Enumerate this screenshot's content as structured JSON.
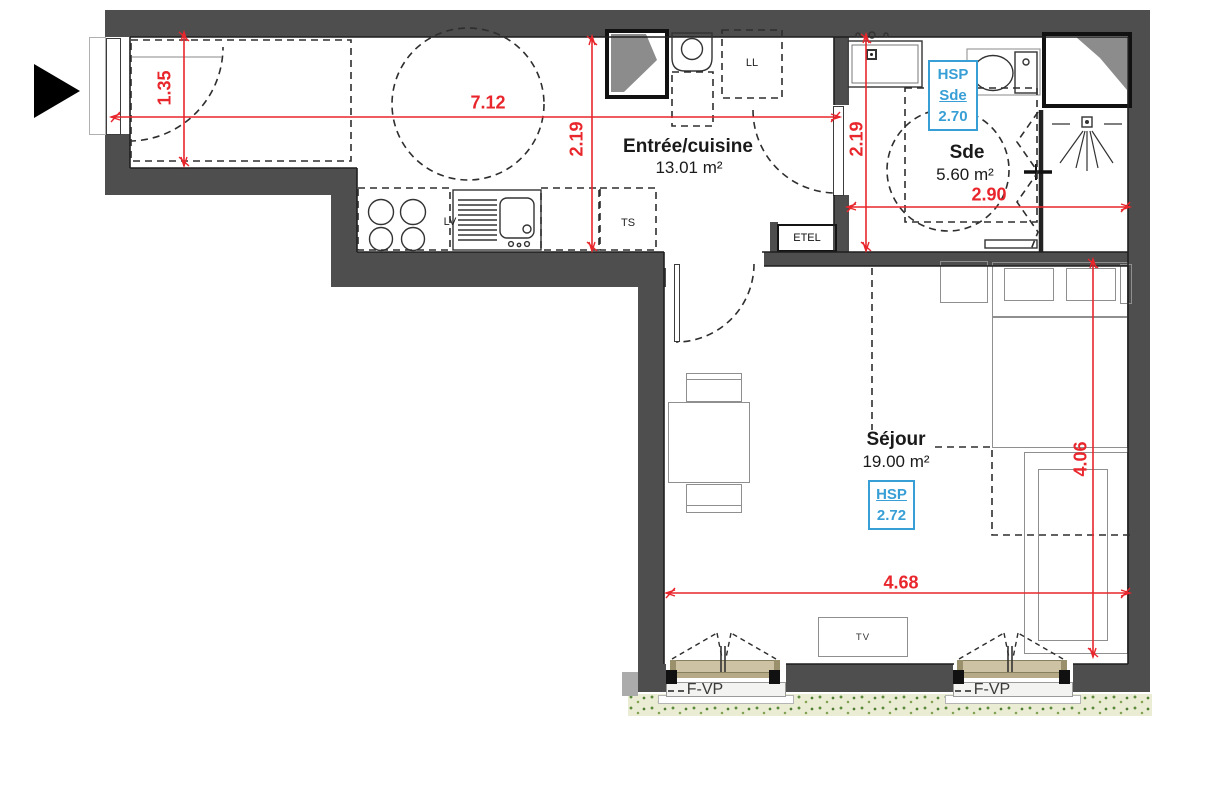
{
  "rooms": {
    "entree": {
      "name": "Entrée/cuisine",
      "area": "13.01 m²"
    },
    "sde": {
      "name": "Sde",
      "area": "5.60 m²"
    },
    "sejour": {
      "name": "Séjour",
      "area": "19.00 m²"
    }
  },
  "dimensions": {
    "closet_height": "1.35",
    "entree_width": "7.12",
    "entree_depth": "2.19",
    "sde_depth": "2.19",
    "sde_width": "2.90",
    "sejour_depth": "4.06",
    "sejour_width": "4.68"
  },
  "ceiling_heights": {
    "sde": {
      "label": "HSP",
      "room": "Sde",
      "value": "2.70"
    },
    "sejour": {
      "label": "HSP",
      "value": "2.72"
    }
  },
  "equipment": {
    "washing_machine": "LL",
    "dishwasher": "LV",
    "technical_shaft": "TS",
    "electrical_enclosure": "ETEL",
    "television": "TV"
  },
  "windows": {
    "window1": "F-VP",
    "window2": "F-VP"
  },
  "colors": {
    "dimension_red": "#e8262c",
    "annotation_blue": "#389fd6",
    "wall_gray": "#4e4e4e",
    "window_frame_tan": "#cec2a4",
    "grass_green": "#6f9548"
  }
}
